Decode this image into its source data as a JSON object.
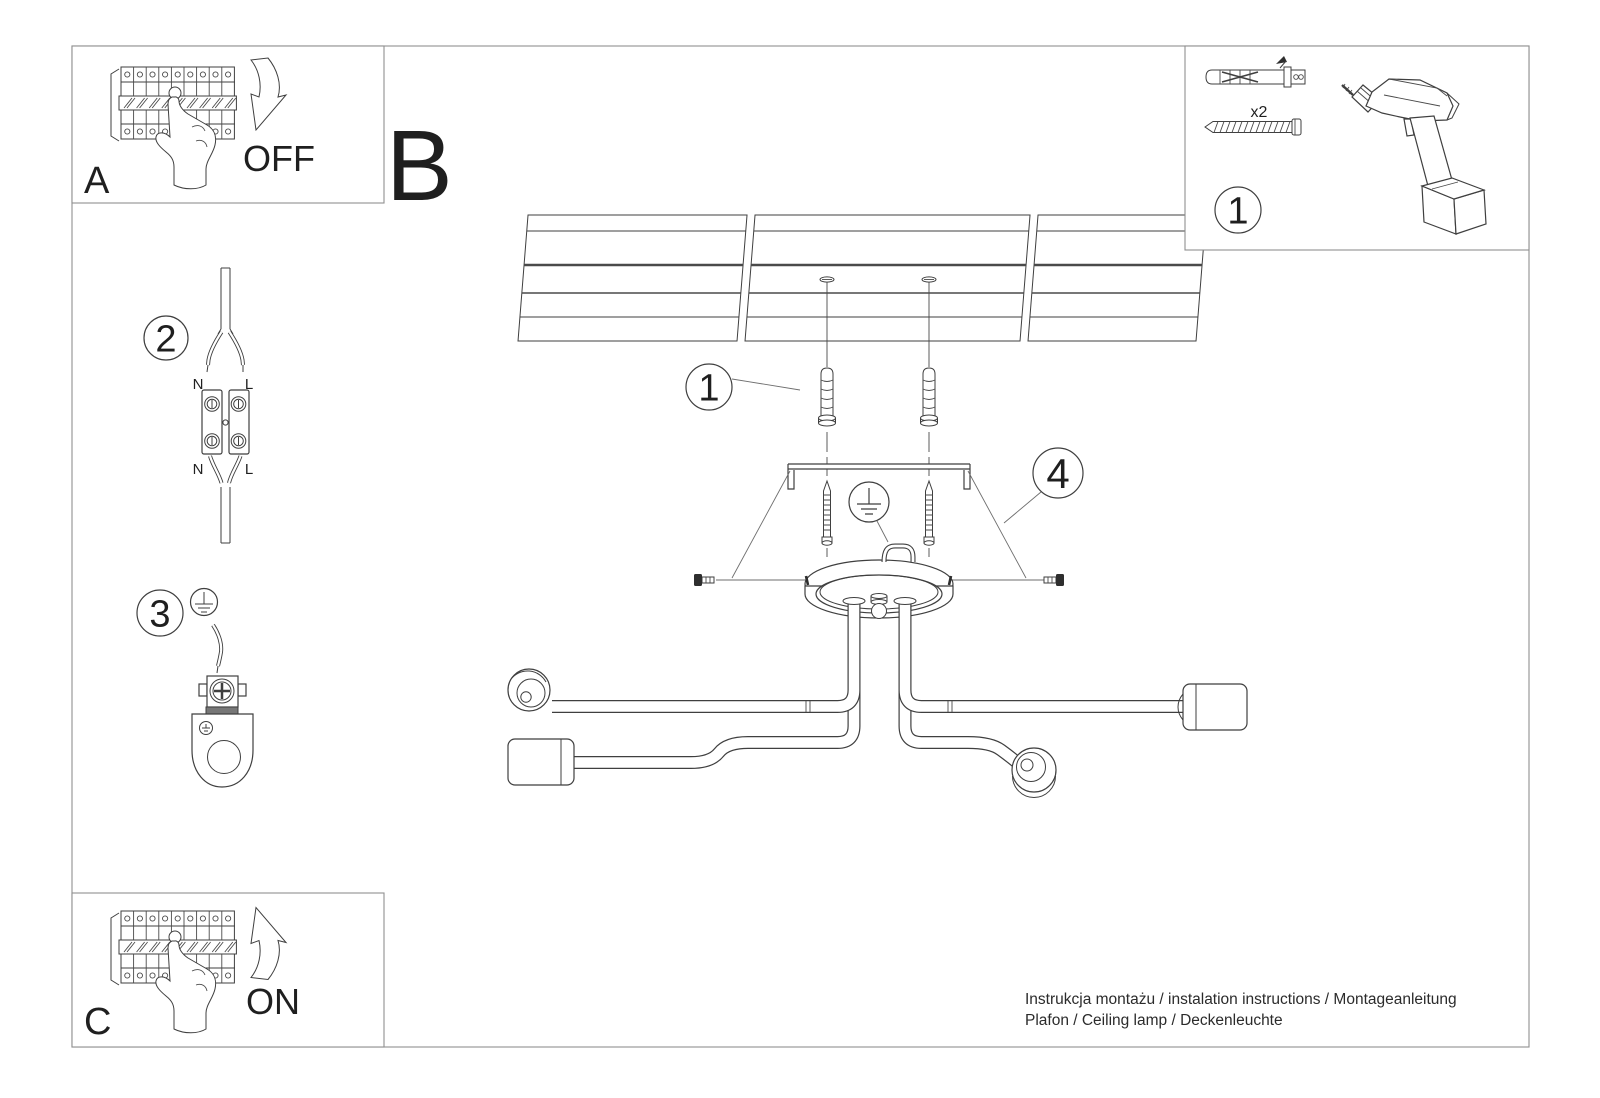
{
  "colors": {
    "line": "#3f3f3f",
    "frame": "#8f8f8f",
    "text": "#1f1f1f",
    "background": "#ffffff"
  },
  "panels": {
    "a": {
      "label": "A",
      "action": "OFF"
    },
    "b": {
      "label": "B"
    },
    "c": {
      "label": "C",
      "action": "ON"
    }
  },
  "callouts": {
    "one": "1",
    "two": "2",
    "three": "3",
    "four": "4"
  },
  "hardware": {
    "anchor_qty": "x2"
  },
  "wiring": {
    "neutral": "N",
    "live": "L"
  },
  "footer": {
    "line1": "Instrukcja montażu / instalation instructions / Montageanleitung",
    "line2": "Plafon / Ceiling lamp / Deckenleuchte"
  }
}
